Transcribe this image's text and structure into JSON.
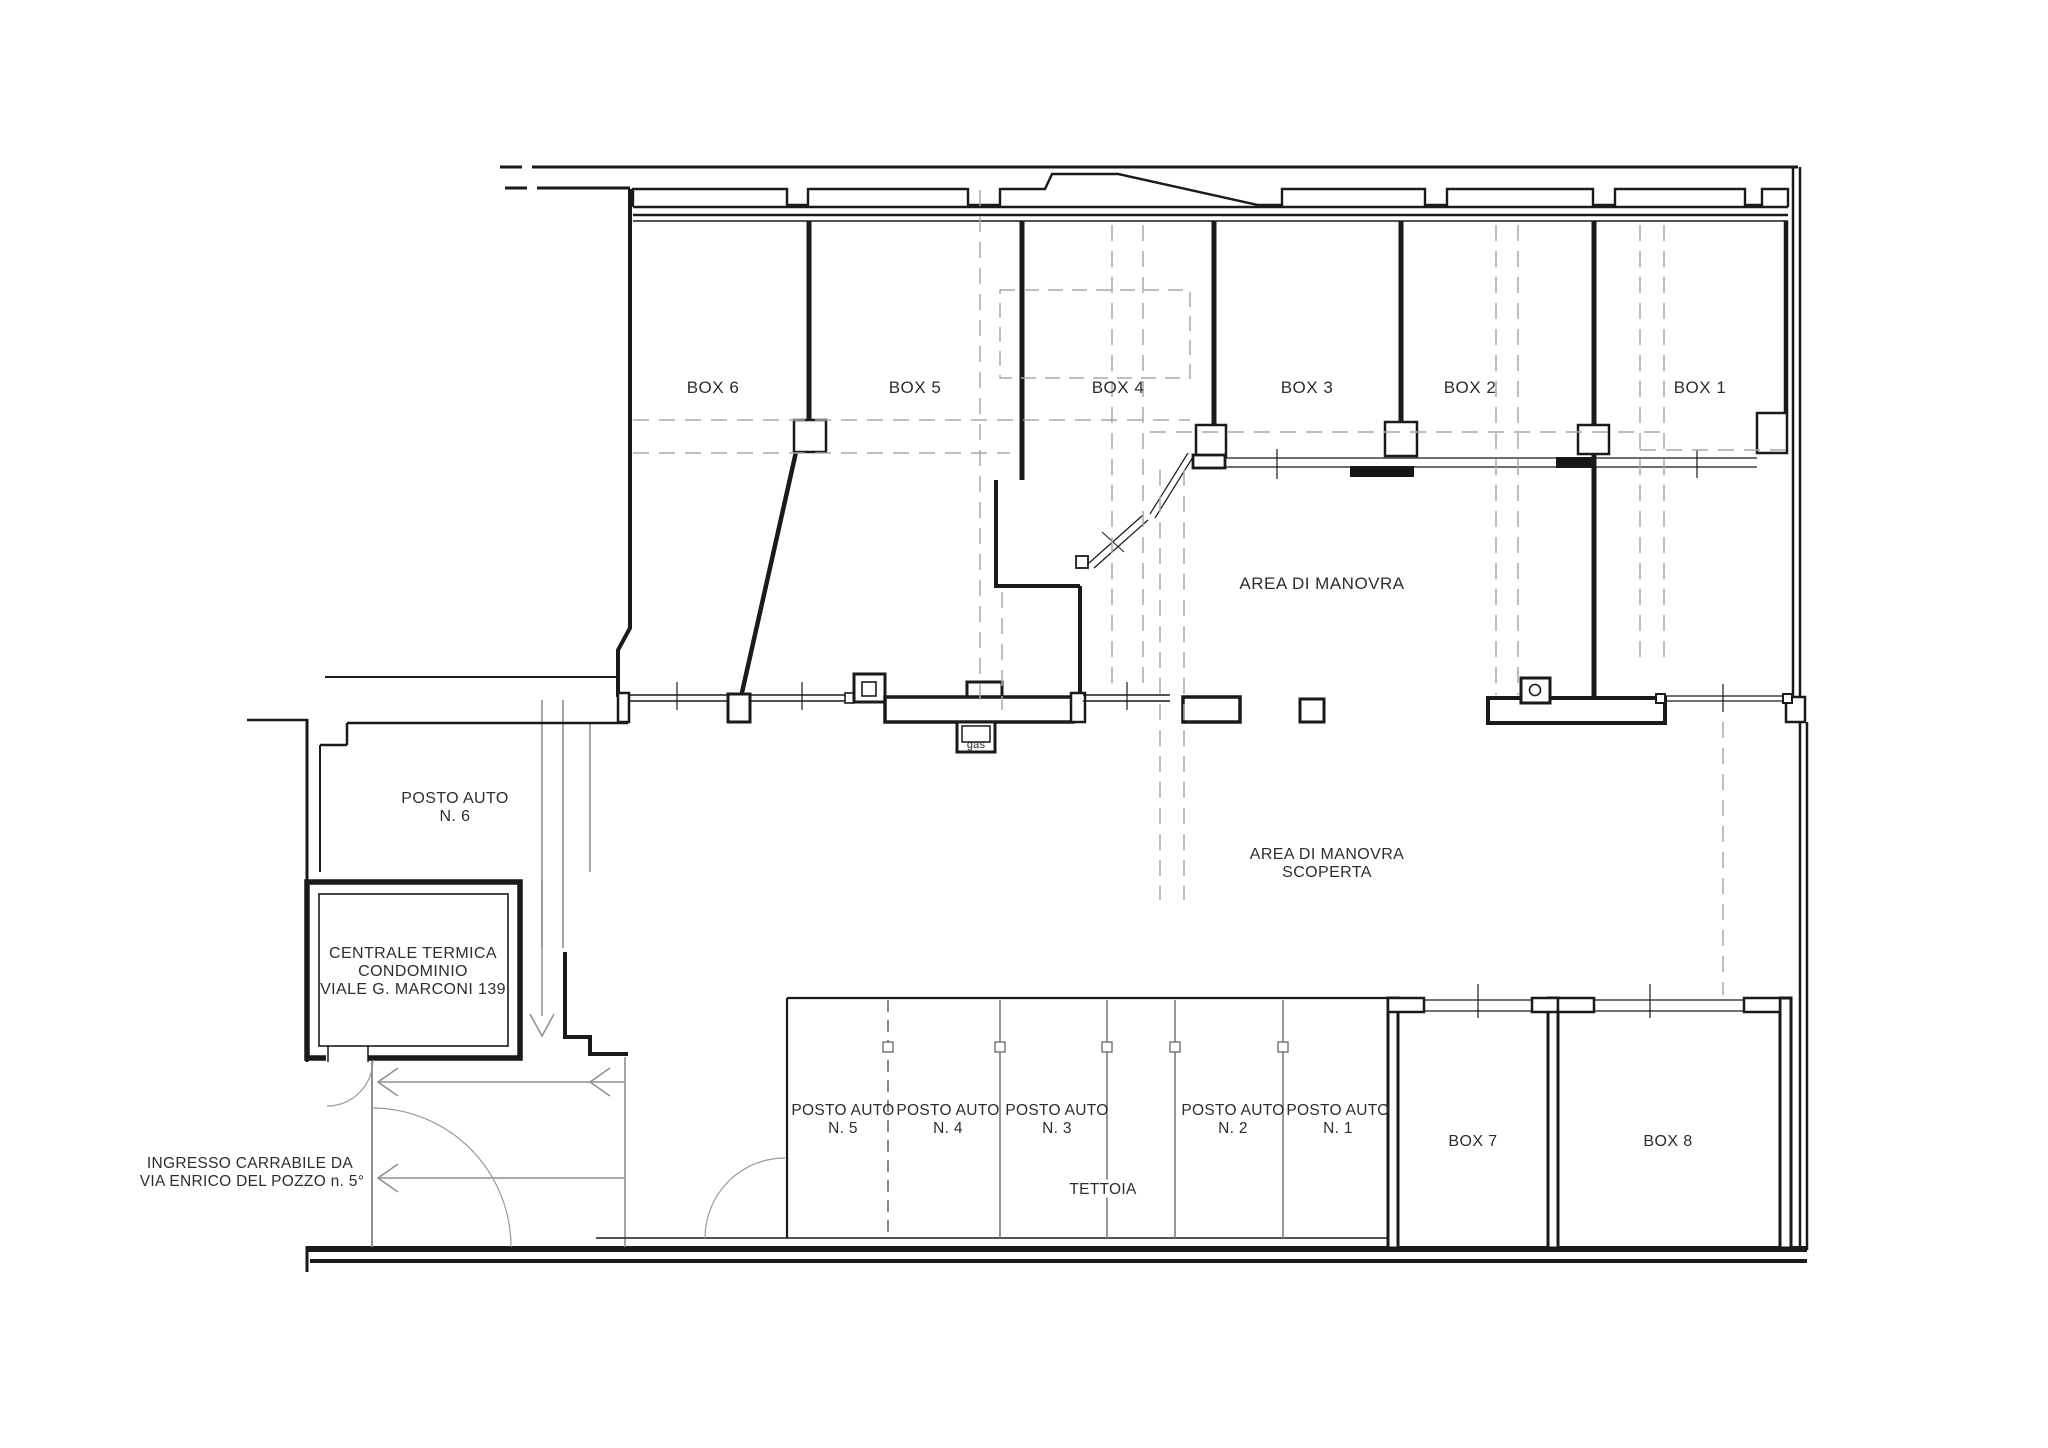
{
  "drawing_type": "floor-plan",
  "colors": {
    "wall": "#1a1a1a",
    "thin_gray": "#8f8f8f",
    "dashed_guide": "#a9a9a9",
    "text": "#2d2d2d",
    "background": "#ffffff"
  },
  "garage_boxes_top": [
    "BOX 6",
    "BOX 5",
    "BOX 4",
    "BOX 3",
    "BOX 2",
    "BOX 1"
  ],
  "garage_boxes_bottom": [
    "BOX 7",
    "BOX 8"
  ],
  "areas": {
    "manovra": "AREA DI MANOVRA",
    "manovra_scoperta_line1": "AREA DI MANOVRA",
    "manovra_scoperta_line2": "SCOPERTA",
    "tettoia": "TETTOIA"
  },
  "parking": {
    "stall_label": "POSTO AUTO",
    "stalls": [
      "N. 5",
      "N. 4",
      "N. 3",
      "N. 2",
      "N. 1"
    ],
    "posto6_line1": "POSTO AUTO",
    "posto6_line2": "N. 6"
  },
  "rooms": {
    "centrale_line1": "CENTRALE TERMICA",
    "centrale_line2": "CONDOMINIO",
    "centrale_line3": "VIALE G. MARCONI 139"
  },
  "annotations": {
    "ingresso_line1": "INGRESSO CARRABILE DA",
    "ingresso_line2": "VIA ENRICO DEL POZZO n. 5°",
    "gas": "gas"
  }
}
